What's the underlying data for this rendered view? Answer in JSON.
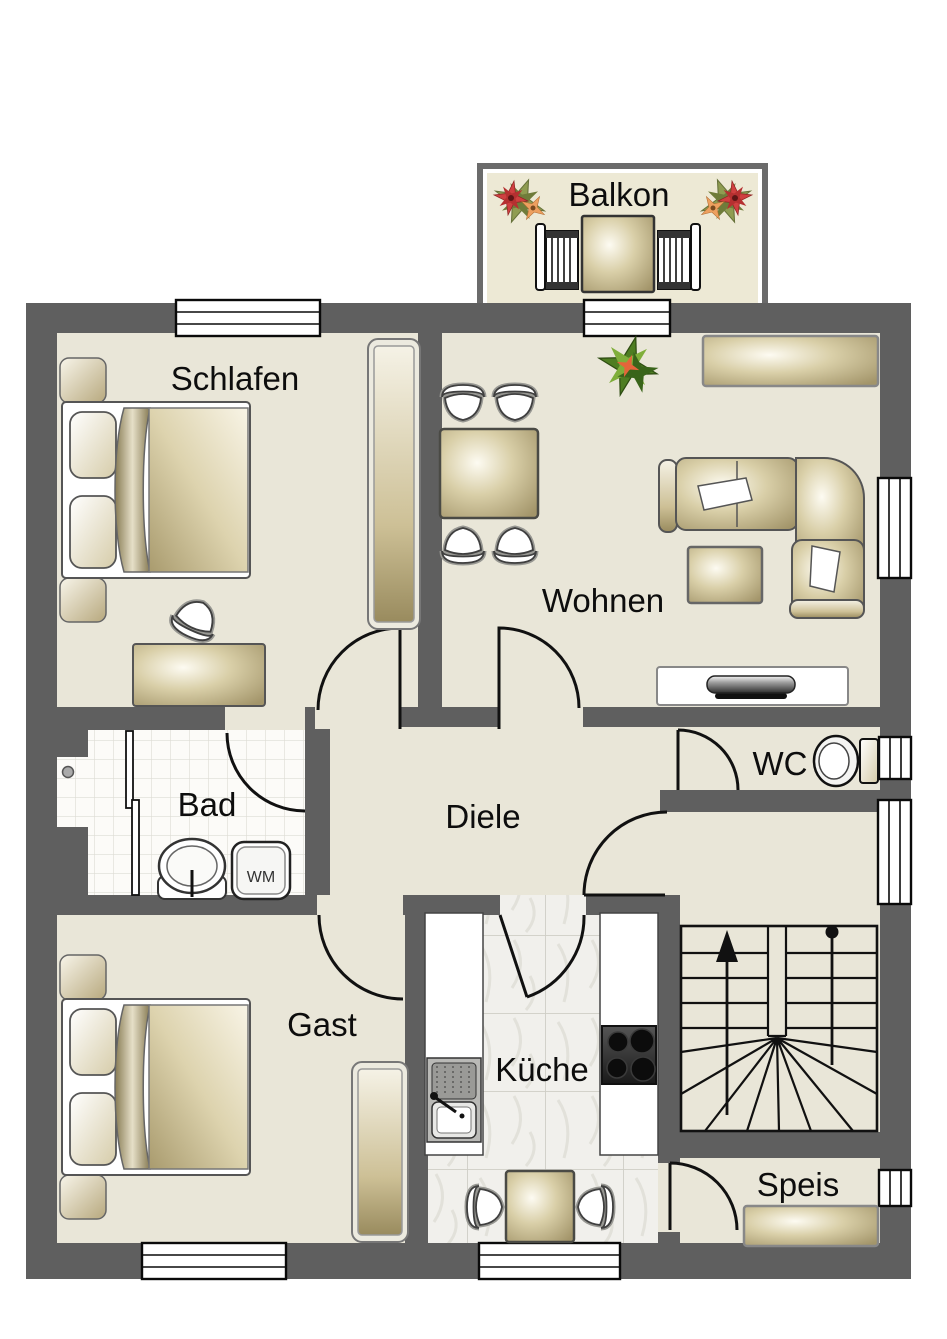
{
  "rooms": {
    "balkon": {
      "label": "Balkon"
    },
    "schlafen": {
      "label": "Schlafen"
    },
    "wohnen": {
      "label": "Wohnen"
    },
    "bad": {
      "label": "Bad"
    },
    "diele": {
      "label": "Diele"
    },
    "wc": {
      "label": "WC"
    },
    "gast": {
      "label": "Gast"
    },
    "kueche": {
      "label": "Küche"
    },
    "speis": {
      "label": "Speis"
    }
  },
  "appliances": {
    "washing_machine_label": "WM"
  },
  "icons": [
    "double-bed-icon",
    "wardrobe-icon",
    "dresser-icon",
    "vanity-stool-icon",
    "dining-table-icon",
    "chair-icon",
    "corner-sofa-icon",
    "coffee-table-icon",
    "sideboard-icon",
    "tv-lowboard-icon",
    "plant-icon",
    "flower-icon",
    "balcony-table-icon",
    "balcony-chair-icon",
    "toilet-icon",
    "bathroom-sink-icon",
    "washing-machine-icon",
    "shower-screen-icon",
    "kitchen-counter-icon",
    "kitchen-sink-icon",
    "stove-icon",
    "kitchen-table-icon",
    "staircase-icon",
    "pantry-shelf-icon",
    "window-icon",
    "door-swing-icon"
  ],
  "colors": {
    "wall": "#5f5f5f",
    "floor": "#e9e6d8",
    "balcony_floor": "#ede9d5",
    "bath_tile": "#fcfbf8",
    "kitchen_tile": "#f1f0ec",
    "furniture_tan_dark": "#a89a6e",
    "furniture_tan_light": "#f9f6ea",
    "outline_black": "#111111",
    "plant_green": "#4e7d22",
    "flower_red": "#cf4040",
    "flower_orange": "#eda05f",
    "window_white": "#ffffff"
  }
}
